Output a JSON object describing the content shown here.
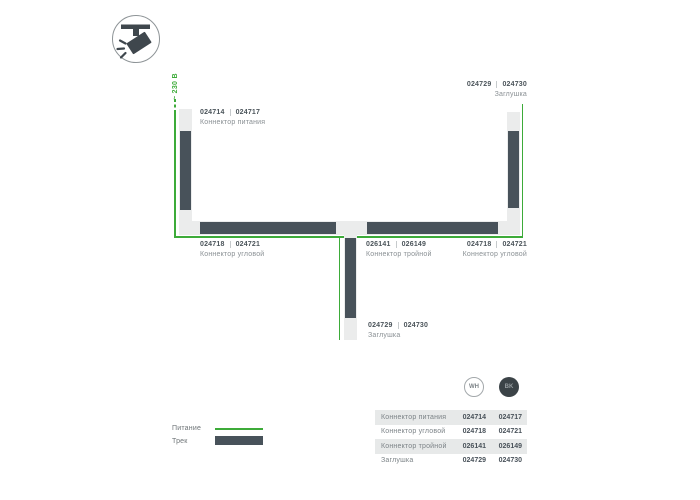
{
  "colors": {
    "power_green": "#3dab39",
    "track_dark": "#48525a",
    "track_light": "#ebecec",
    "code_text": "#4b545a",
    "name_text": "#8a9094",
    "table_stripe": "#e7e9e9"
  },
  "header_icon": {
    "name": "track-spotlight-icon"
  },
  "diagram": {
    "voltage": "~ 230 В",
    "power": {
      "wh": "024714",
      "bk": "024717",
      "name": "Коннектор питания"
    },
    "endcap_top": {
      "wh": "024729",
      "bk": "024730",
      "name": "Заглушка"
    },
    "corner_left": {
      "wh": "024718",
      "bk": "024721",
      "name": "Коннектор угловой"
    },
    "triple": {
      "wh": "026141",
      "bk": "026149",
      "name": "Коннектор тройной"
    },
    "corner_right": {
      "wh": "024718",
      "bk": "024721",
      "name": "Коннектор угловой"
    },
    "endcap_bottom": {
      "wh": "024729",
      "bk": "024730",
      "name": "Заглушка"
    }
  },
  "variants": {
    "white": "WH",
    "black": "BK"
  },
  "legend": {
    "power": "Питание",
    "track": "Трек"
  },
  "table": {
    "rows": [
      {
        "name": "Коннектор питания",
        "wh": "024714",
        "bk": "024717"
      },
      {
        "name": "Коннектор угловой",
        "wh": "024718",
        "bk": "024721"
      },
      {
        "name": "Коннектор тройной",
        "wh": "026141",
        "bk": "026149"
      },
      {
        "name": "Заглушка",
        "wh": "024729",
        "bk": "024730"
      }
    ]
  }
}
